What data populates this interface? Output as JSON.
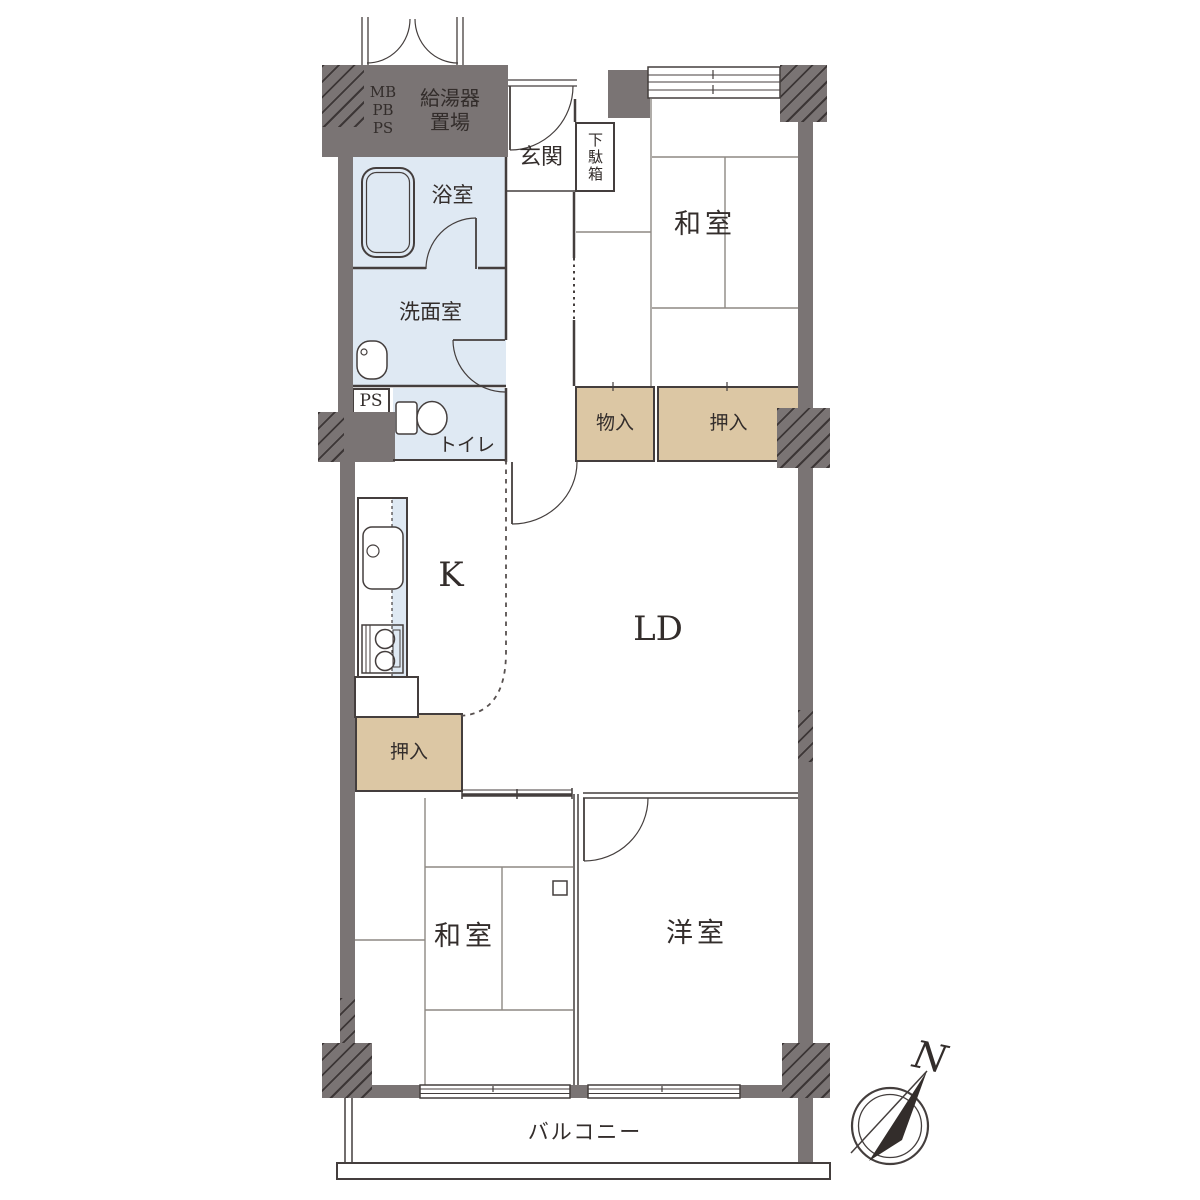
{
  "colors": {
    "wall": "#7a7474",
    "line": "#443e3d",
    "room_blue": "#dfe9f3",
    "closet_tan": "#dcc7a4",
    "text": "#332d2b",
    "tatami_line": "#8d8883"
  },
  "labels": {
    "meter": {
      "line1": "MB",
      "line2": "PB",
      "line3": "PS"
    },
    "water_heater": {
      "line1": "給湯器",
      "line2": "置場"
    },
    "entry": "玄関",
    "shoe_cabinet": "下駄箱",
    "japanese_room_upper": "和室",
    "bathroom": "浴室",
    "washroom": "洗面室",
    "pipe_space": "PS",
    "toilet": "トイレ",
    "storage": "物入",
    "closet_upper": "押入",
    "kitchen": "K",
    "living_dining": "LD",
    "closet_lower": "押入",
    "japanese_room_lower": "和室",
    "western_room": "洋室",
    "balcony": "バルコニー",
    "compass_north": "N"
  }
}
